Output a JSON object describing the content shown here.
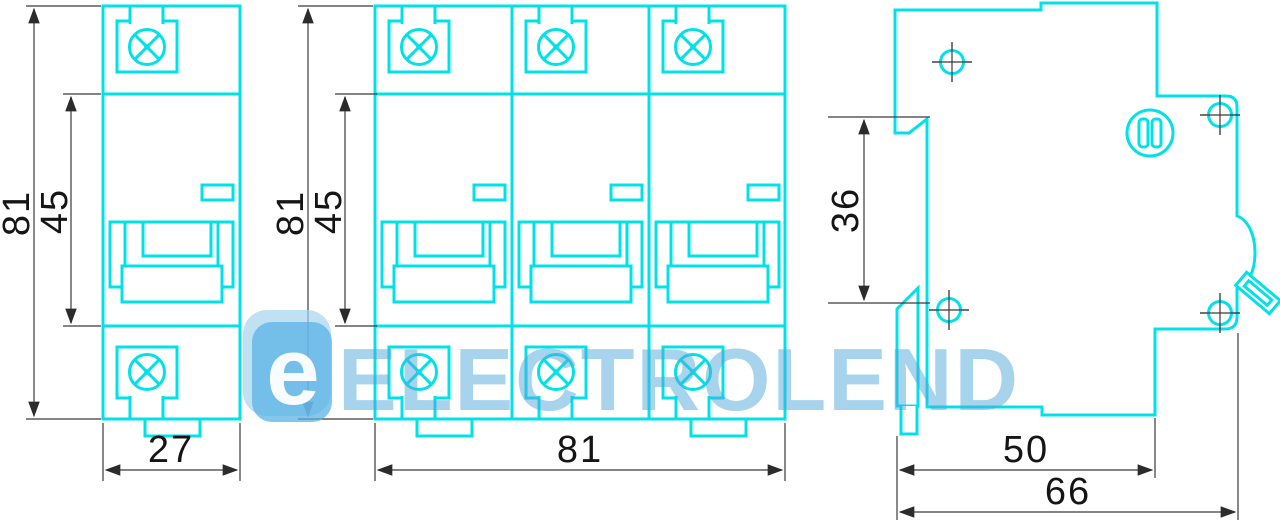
{
  "diagram": {
    "title": "circuit-breaker-dimensional-drawing",
    "background": "#ffffff",
    "line_color": "#00E1E8",
    "dimension_color": "#3a3a3a",
    "text_color": "#151515"
  },
  "views": {
    "single_pole": {
      "height_mm": "81",
      "window_mm": "45",
      "width_mm": "27"
    },
    "three_pole": {
      "height_mm": "81",
      "window_mm": "45",
      "width_mm": "81"
    },
    "side": {
      "rail_mm": "36",
      "depth_mm": "50",
      "total_depth_mm": "66"
    }
  },
  "watermark": {
    "text": "ELECTROLEND",
    "logo_letter": "e"
  }
}
